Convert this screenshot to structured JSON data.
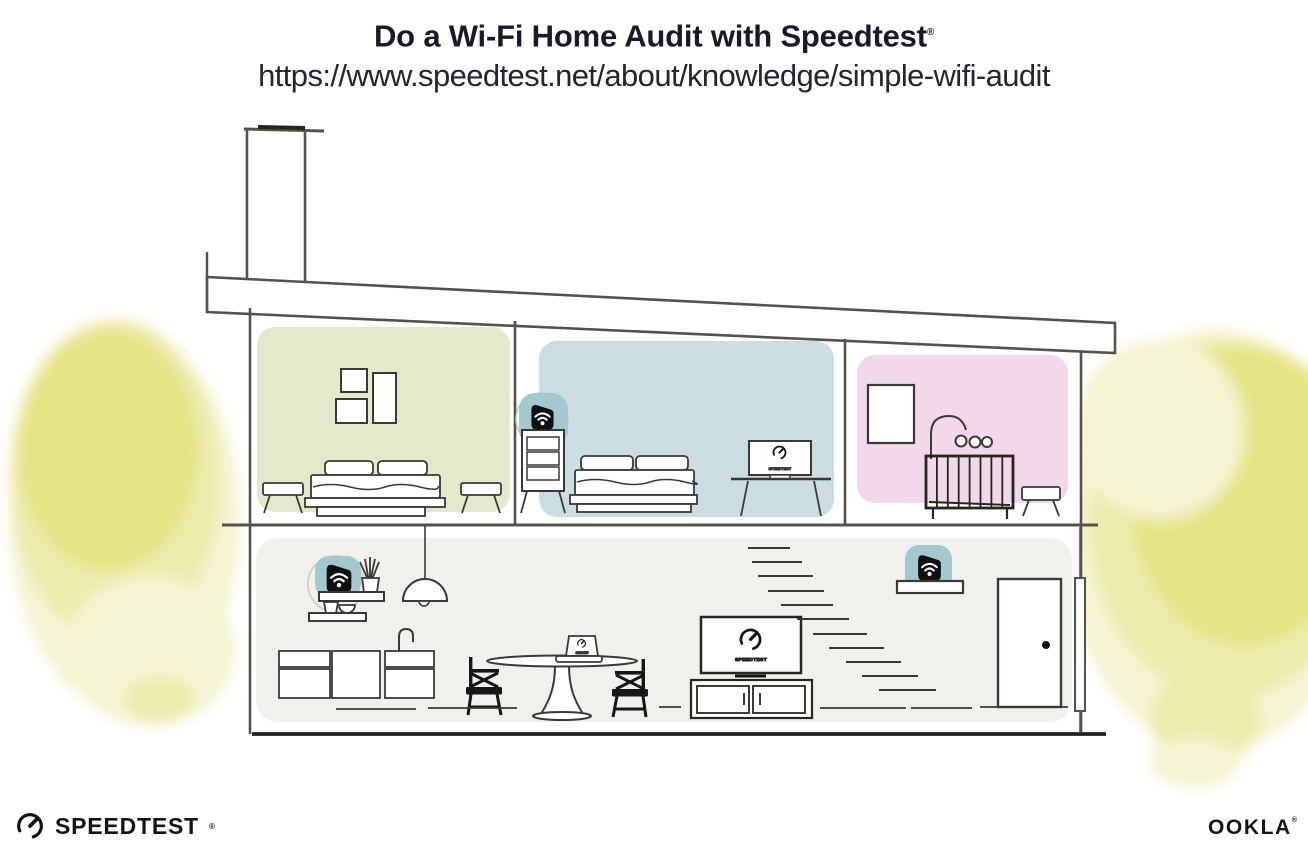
{
  "header": {
    "title": "Do a Wi-Fi Home Audit with Speedtest",
    "registered_mark": "®",
    "url": "https://www.speedtest.net/about/knowledge/simple-wifi-audit"
  },
  "illustration": {
    "screen_label": "SPEEDTEST",
    "rooms": {
      "bedroom_left": {
        "name": "bedroom-green",
        "color": "#e2eacb"
      },
      "bedroom_middle": {
        "name": "bedroom-blue",
        "color": "#cbdde0"
      },
      "nursery_right": {
        "name": "nursery-pink",
        "color": "#f2d8e8"
      },
      "main_floor": {
        "name": "main-floor",
        "color": "#f1f0ed"
      }
    },
    "colors": {
      "device_highlight_teal": "#a3c8cd",
      "tree_yellow": "#e5e484",
      "tree_yellow_mid": "#ecebaa",
      "tree_yellow_light": "#f4f4d0",
      "outline": "#55524b",
      "furniture": "#3b3936",
      "device_black": "#101010"
    },
    "icons": {
      "wifi_device": "black-shield-with-white-wifi-waves",
      "speedtest_gauge": "open-circle-gauge-with-needle"
    }
  },
  "footer": {
    "speedtest": {
      "label": "SPEEDTEST",
      "registered_mark": "®"
    },
    "ookla": {
      "label": "OOKLA",
      "registered_mark": "®"
    }
  }
}
